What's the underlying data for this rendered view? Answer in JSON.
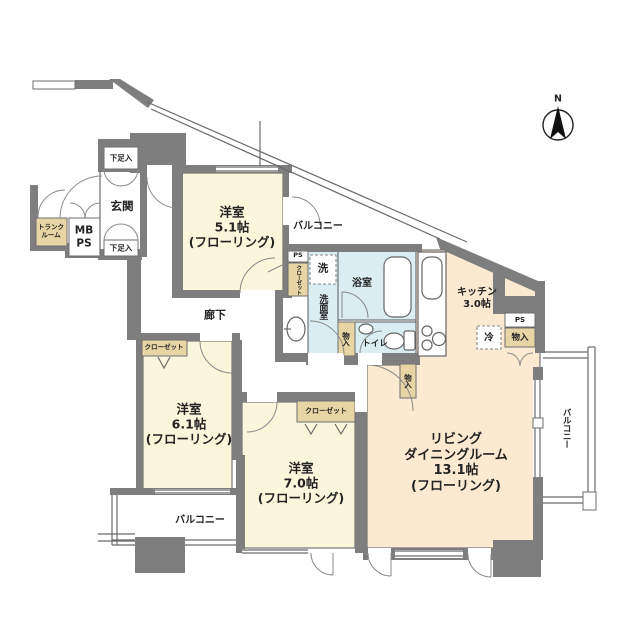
{
  "colors": {
    "wall": "#7e7e7e",
    "cream": "#faf6dc",
    "peach": "#fbe9d2",
    "wet": "#d9edf2",
    "tan": "#e8d5a6",
    "line": "#5a5a5a"
  },
  "compass": {
    "north_label": "N"
  },
  "rooms": {
    "bedroom1": {
      "name": "洋室",
      "size": "5.1帖",
      "floor": "(フローリング)"
    },
    "bedroom2": {
      "name": "洋室",
      "size": "6.1帖",
      "floor": "(フローリング)"
    },
    "bedroom3": {
      "name": "洋室",
      "size": "7.0帖",
      "floor": "(フローリング)"
    },
    "living": {
      "name1": "リビング",
      "name2": "ダイニングルーム",
      "size": "13.1帖",
      "floor": "(フローリング)"
    },
    "kitchen": {
      "name": "キッチン",
      "size": "3.0帖"
    },
    "bathroom": {
      "name": "浴室"
    },
    "washroom": {
      "name": "洗面室"
    },
    "toilet": {
      "name": "トイレ"
    },
    "hallway": {
      "name": "廊下"
    },
    "entrance": {
      "name": "玄関"
    }
  },
  "storage": {
    "closet1": "クローゼット",
    "closet2": "クローゼット",
    "closet3": "クローゼット",
    "monoire1": "物入",
    "monoire2": "物入",
    "monoire3": "物入",
    "shoebox1": "下足入",
    "shoebox2": "下足入",
    "trunk_line1": "トランク",
    "trunk_line2": "ルーム",
    "mb_line": "MB",
    "ps_line": "PS",
    "ps1": "PS",
    "ps2": "PS",
    "fridge": "冷",
    "washer": "洗"
  },
  "balconies": {
    "top": "バルコニー",
    "bottom_left": "バルコニー",
    "right": "バルコニー"
  }
}
